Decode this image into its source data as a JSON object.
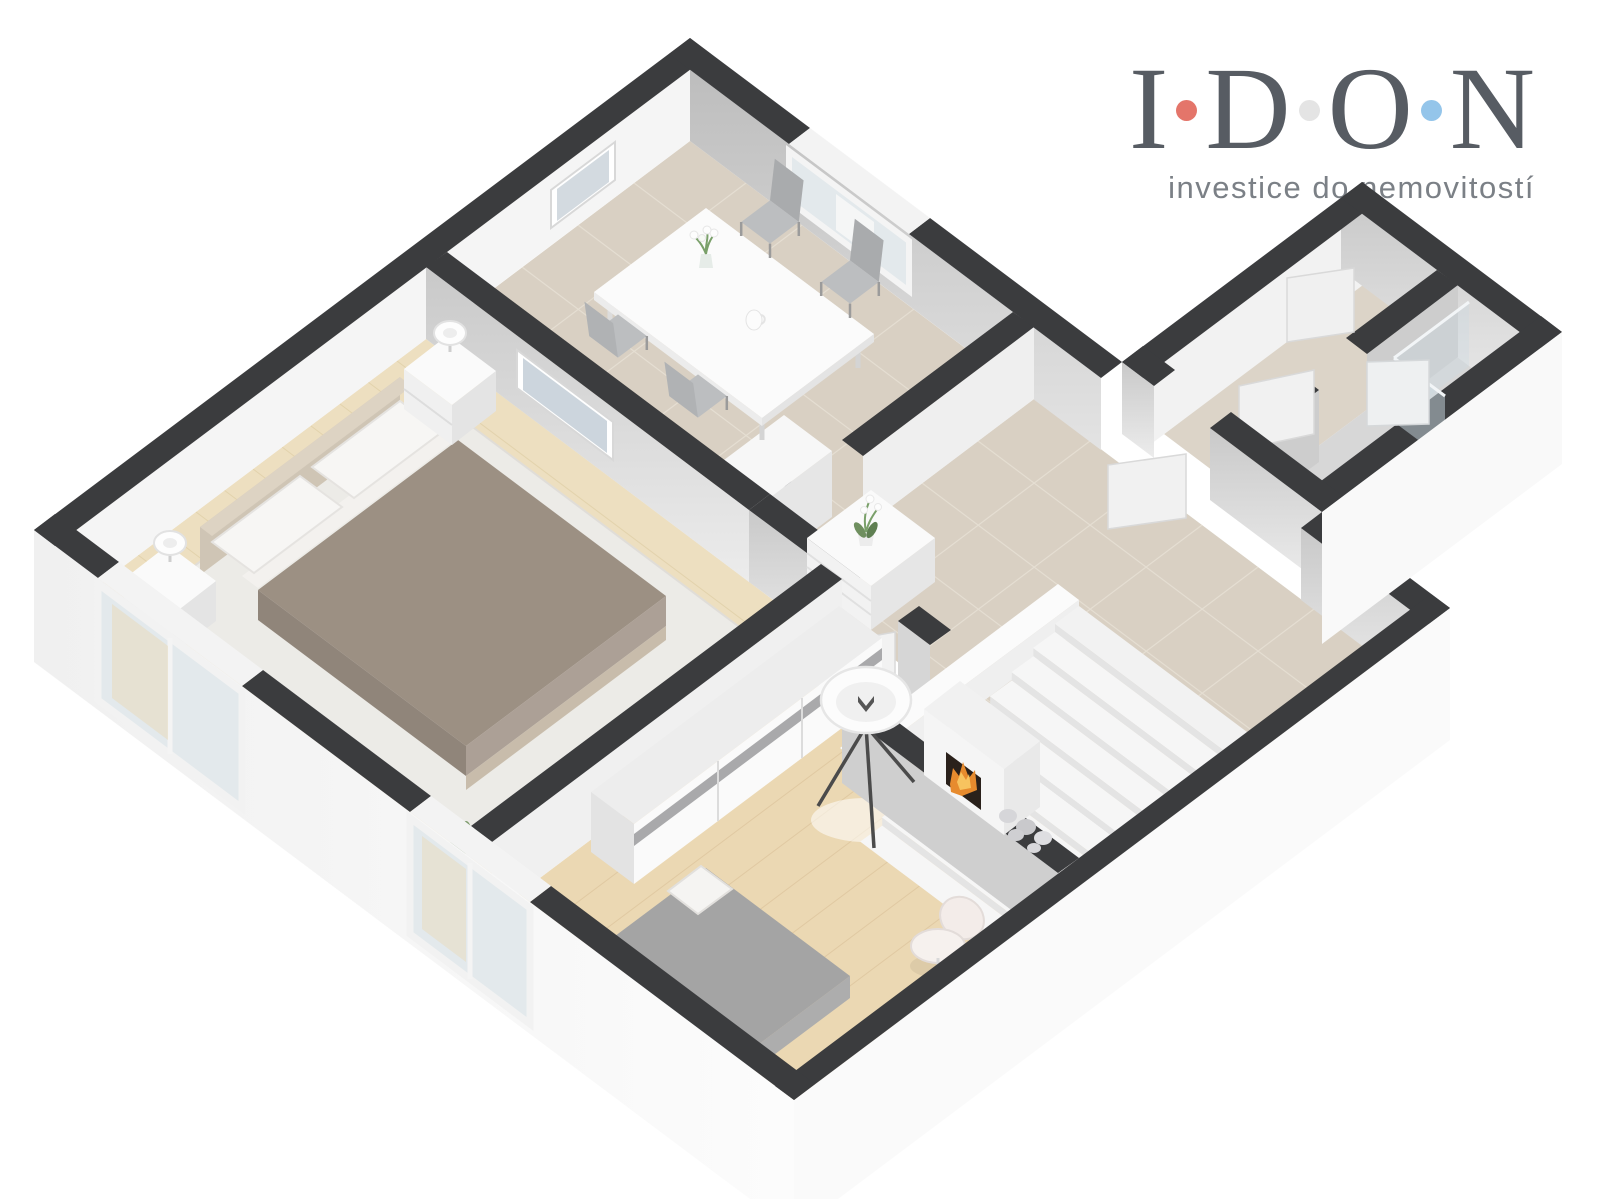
{
  "page": {
    "background": "#ffffff"
  },
  "logo": {
    "letters": [
      "I",
      "D",
      "O",
      "N"
    ],
    "separator_dot_colors": [
      "#e4756a",
      "#e4e4e4",
      "#94c5ea"
    ],
    "letter_color": "#575c63",
    "tagline": "investice do nemovitostí",
    "tagline_color": "#7b8086"
  },
  "scene": {
    "type": "isometric-3d-floor-plan",
    "colors": {
      "wall_top": "#3b3c3e",
      "wall_white": "#f5f5f5",
      "wall_gray": "#c6c6c6",
      "exterior": "#f8f8f8",
      "tile_floor": "#d9d0c3",
      "entry_tile": "#dcd4c8",
      "bath_floor": "#d7d7d7",
      "wood_bedroom": "#eddfc0",
      "wood_living": "#ebd8b3",
      "rug": "#ecebe7",
      "duvet": "#9c9083",
      "headboard": "#cfc5b5",
      "chair_gray": "#bcbec0",
      "stair_tread": "#f6f6f6",
      "flame": "#e78b2e",
      "plant_green": "#6f8f5f",
      "glass": "#ccd9e2",
      "window_glass": "#e3e9ec"
    },
    "rooms": [
      {
        "name": "bedroom",
        "items": [
          "double-bed",
          "headboard",
          "pillow",
          "pillow",
          "nightstand",
          "table-lamp",
          "nightstand",
          "table-lamp",
          "rug",
          "wall-picture",
          "plant",
          "french-window"
        ]
      },
      {
        "name": "dining-room",
        "items": [
          "dining-table",
          "chair",
          "chair",
          "chair",
          "chair",
          "flower-vase",
          "pitcher",
          "window",
          "wall-picture",
          "tall-cabinet",
          "door"
        ]
      },
      {
        "name": "hallway",
        "items": [
          "dresser",
          "orchid",
          "staircase",
          "door",
          "door"
        ]
      },
      {
        "name": "living-room",
        "items": [
          "wardrobe",
          "floor-lamp",
          "fireplace",
          "decorative-stones",
          "single-bed",
          "desk",
          "desk-chair",
          "window",
          "door"
        ]
      },
      {
        "name": "entry",
        "items": [
          "door",
          "door"
        ]
      },
      {
        "name": "bathroom",
        "items": [
          "shower-enclosure",
          "door"
        ]
      }
    ]
  }
}
